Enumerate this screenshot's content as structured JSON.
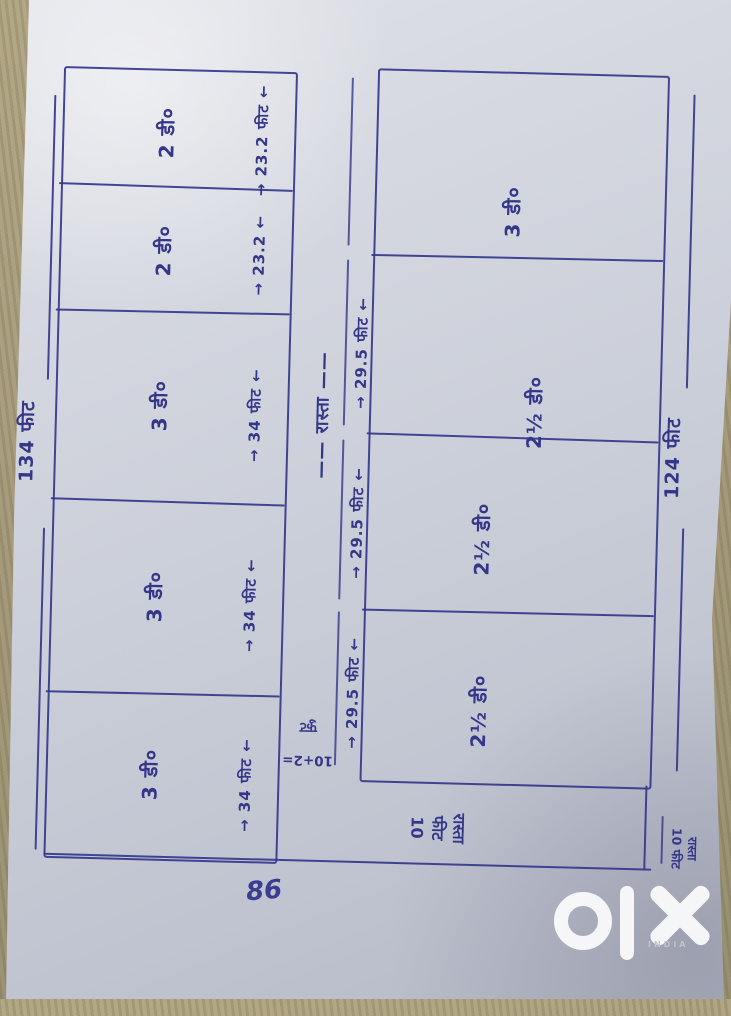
{
  "colors": {
    "ink": "#373a8c",
    "paper": "#ccd0da",
    "background": "#a69c80",
    "watermark": "#ffffff"
  },
  "page_number": "86",
  "watermark": {
    "brand": "olx",
    "country": "INDIA"
  },
  "diagram": {
    "overall_left_dimension": "134 फीट",
    "overall_right_dimension": "124 फीट",
    "left_block": {
      "plots": [
        {
          "label": "2 डी०",
          "dim": "→ 23.2 फीट ←"
        },
        {
          "label": "2 डी०",
          "dim": "→ 23.2 ←"
        },
        {
          "label": "3 डी०",
          "dim": "→ 34 फीट ←"
        },
        {
          "label": "3 डी०",
          "dim": "→ 34 फीट ←"
        },
        {
          "label": "3 डी०",
          "dim": "→ 34 फीट ←"
        }
      ]
    },
    "right_block": {
      "plots": [
        {
          "label": "3 डी०",
          "dim": ""
        },
        {
          "label": "2½ डी०",
          "dim": "→ 29.5 फीट ←"
        },
        {
          "label": "2½ डी०",
          "dim": "→ 29.5 फीट ←"
        },
        {
          "label": "2½ डी०",
          "dim": "→ 29.5 फीट ←"
        }
      ]
    },
    "middle_road_label": "—— रास्ता ——",
    "road_width_note": {
      "lines": [
        "10+2=",
        "फुट"
      ]
    },
    "bottom_road_label": {
      "text": "10 फीट रास्ता",
      "columns": [
        "रास्ता",
        "फीट",
        "10"
      ]
    },
    "corner_road_label": {
      "text": "10 फीट रास्ता",
      "columns": [
        "रास्ता",
        "10 फीट"
      ]
    }
  }
}
